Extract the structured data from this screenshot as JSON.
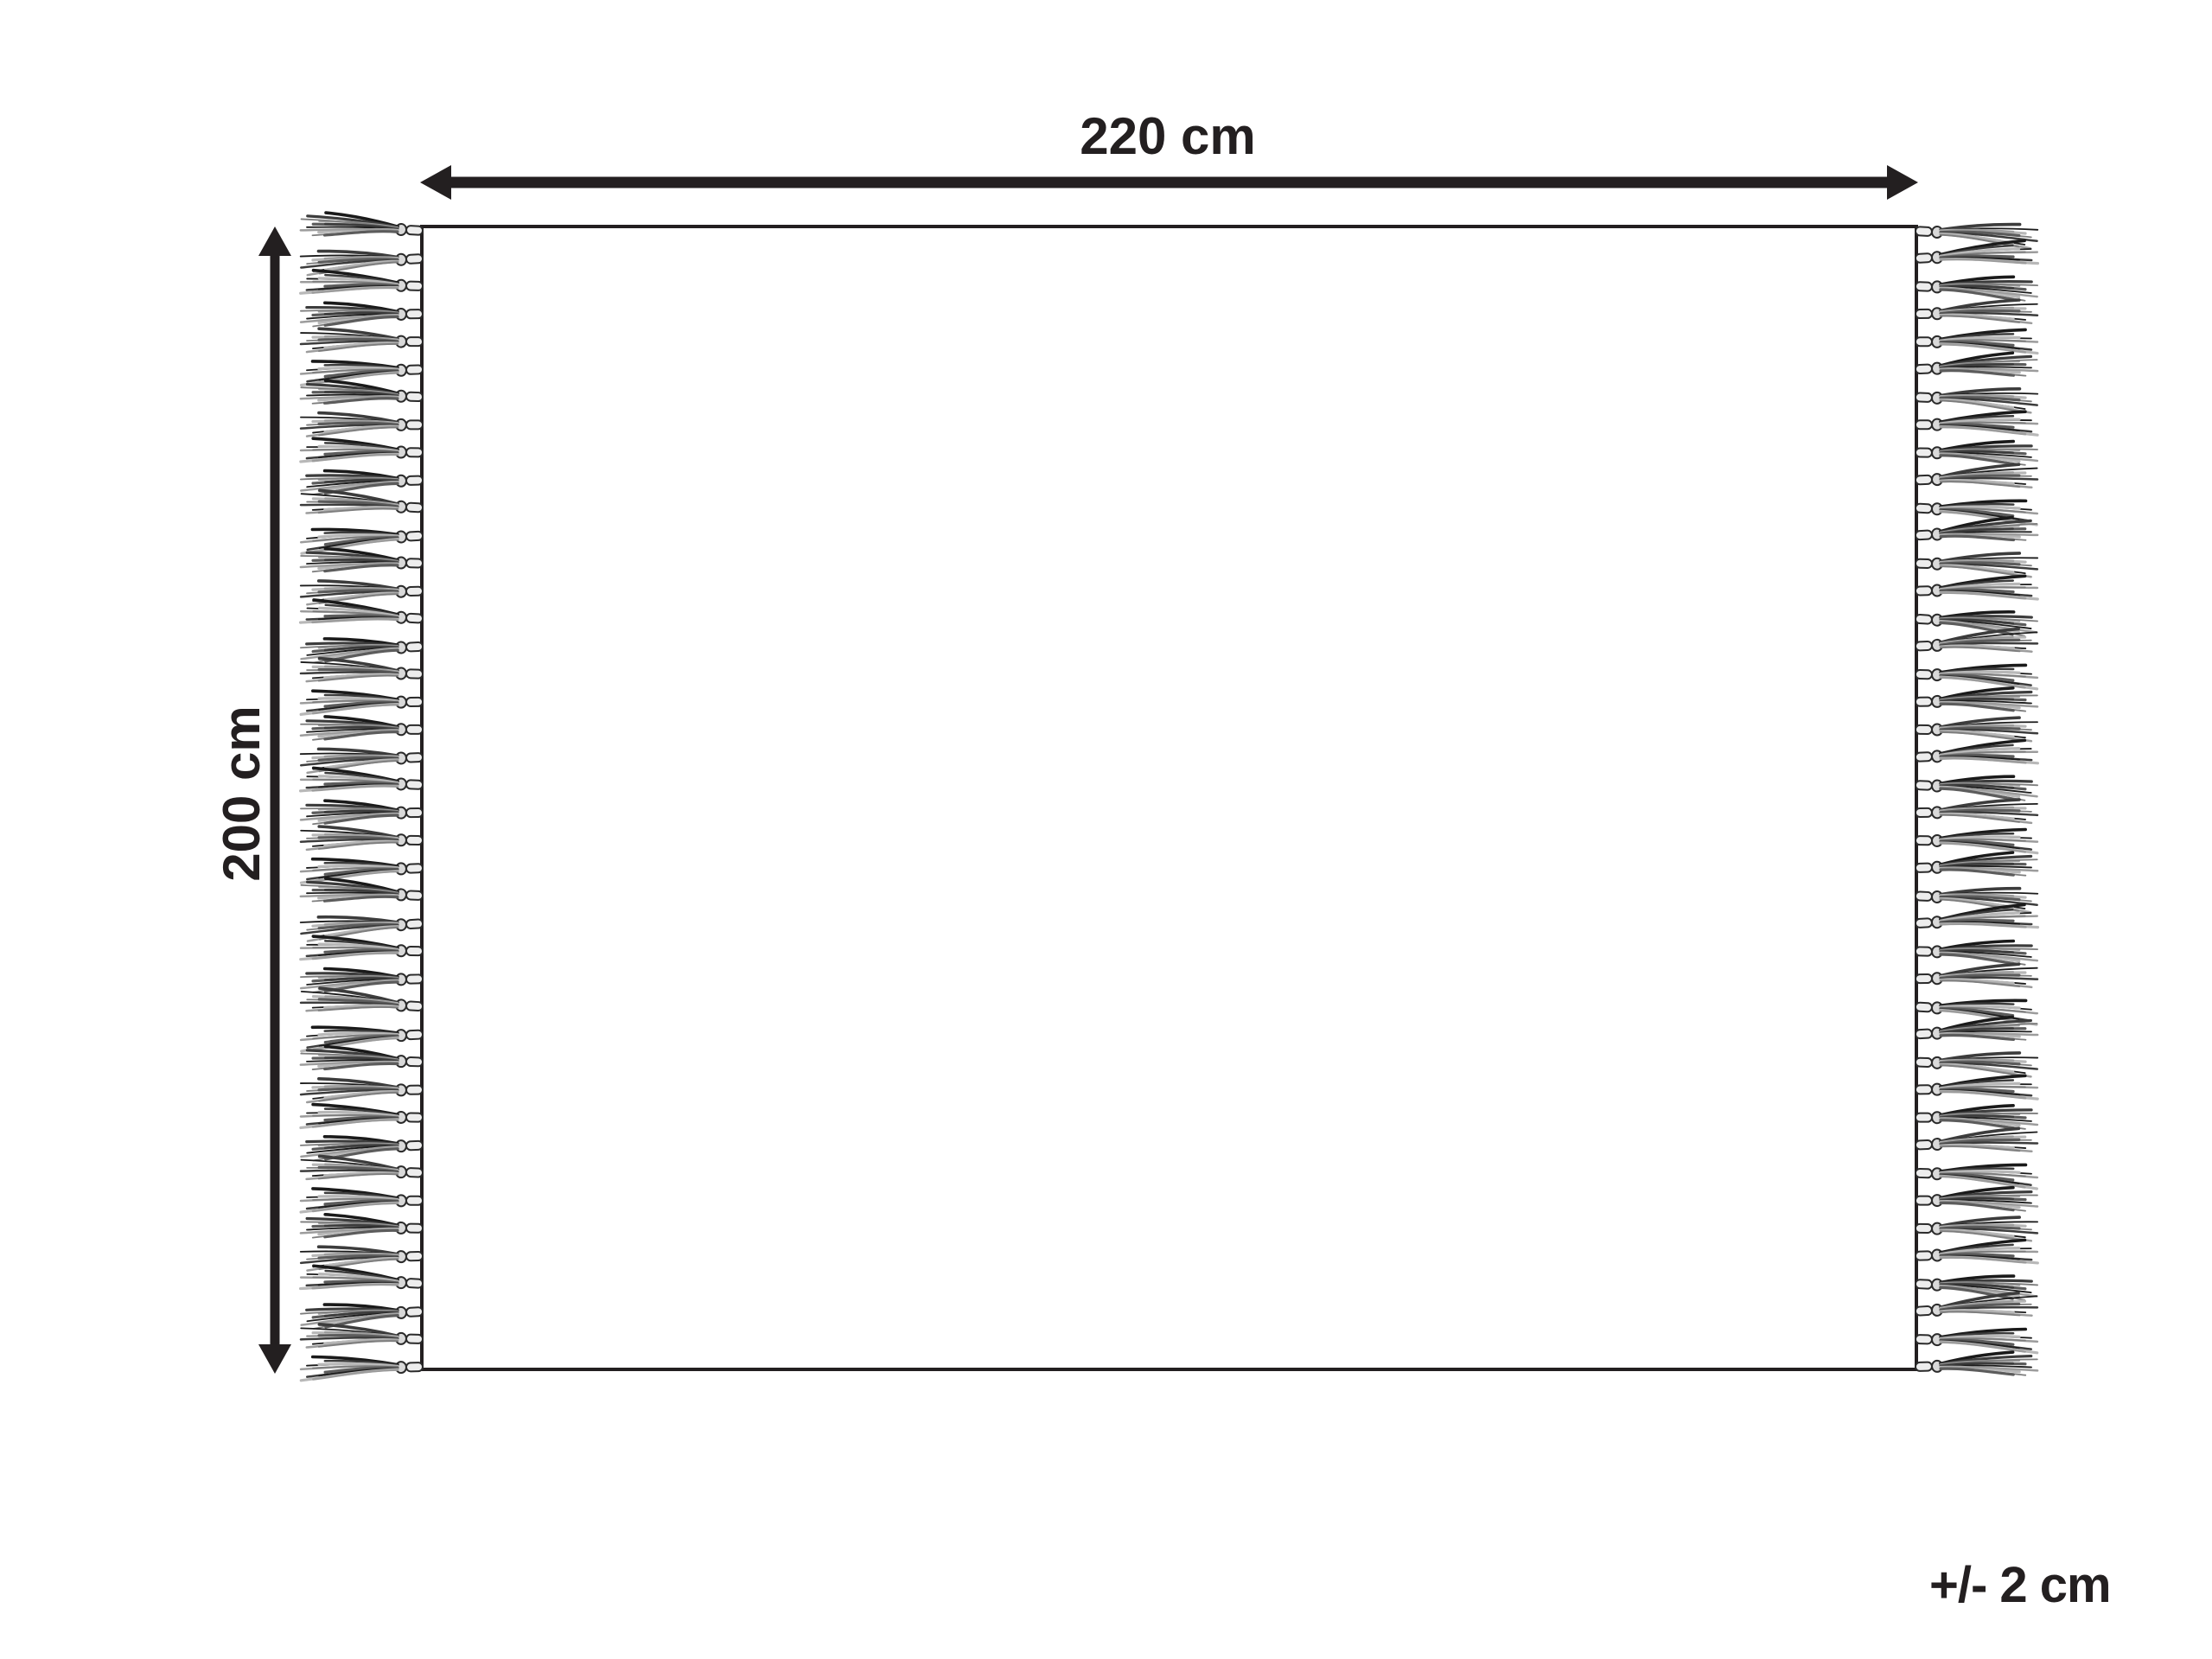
{
  "diagram": {
    "title": "rug dimension diagram",
    "width_label": "220 cm",
    "height_label": "200 cm",
    "tolerance_label": "+/- 2 cm"
  },
  "colors": {
    "ink": "#231f20",
    "background": "#ffffff",
    "rug_fill": "#ffffff",
    "stem_fill": "#ededed",
    "bead_fill": "#d9d9d9",
    "strand_shades": [
      "#1a1a1a",
      "#3c3c3c",
      "#5c5c5c",
      "#7d7d7d",
      "#9c9c9c",
      "#b8b8b8"
    ]
  },
  "fringe": {
    "tassels_per_side": 42,
    "sides": [
      "left",
      "right"
    ]
  }
}
